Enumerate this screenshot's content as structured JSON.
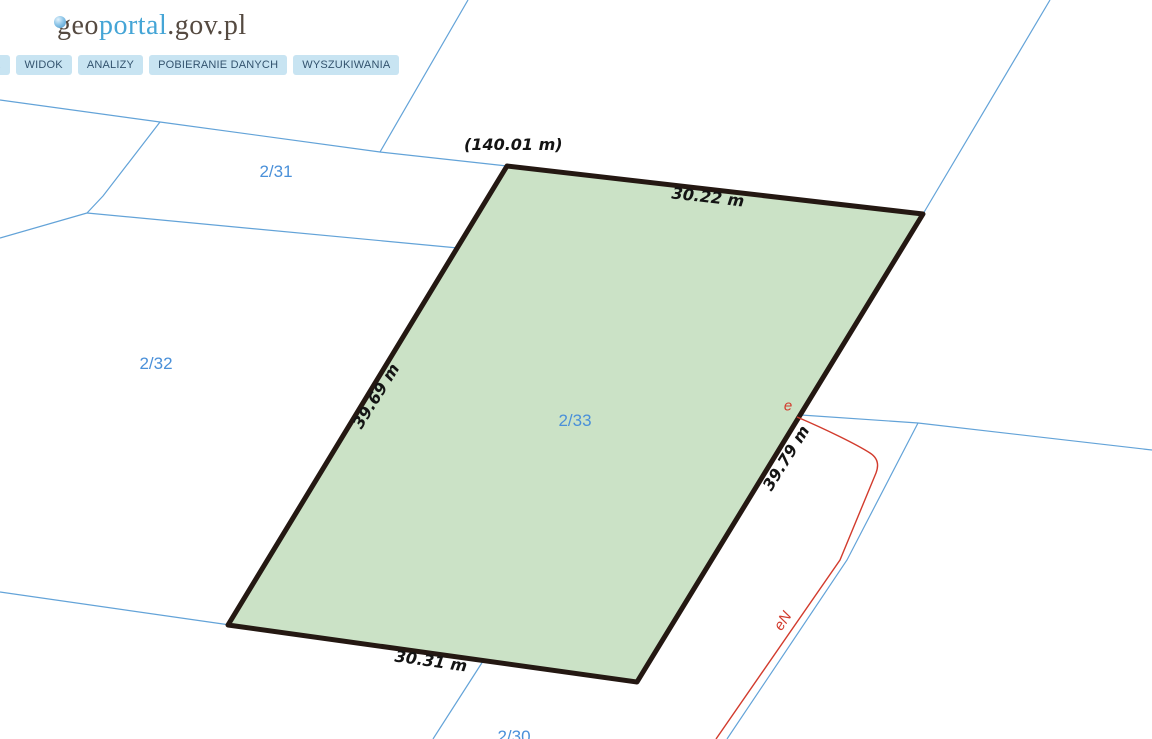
{
  "header": {
    "logo": {
      "geo": "geo",
      "portal": "portal",
      "suffix": ".gov.pl"
    },
    "menu": [
      {
        "label": "K"
      },
      {
        "label": "WIDOK"
      },
      {
        "label": "ANALIZY"
      },
      {
        "label": "POBIERANIE DANYCH"
      },
      {
        "label": "WYSZUKIWANIA"
      }
    ]
  },
  "map": {
    "parcels": [
      {
        "id": "2/31"
      },
      {
        "id": "2/32"
      },
      {
        "id": "2/33"
      },
      {
        "id": "2/30"
      }
    ],
    "selected_parcel": {
      "id": "2/33",
      "perimeter_total": "(140.01 m)",
      "sides": {
        "top": "30.22 m",
        "left": "39.69 m",
        "right": "39.79 m",
        "bottom": "30.31 m"
      }
    },
    "annotations": {
      "point_label": "e",
      "line_label": "eN"
    },
    "colors": {
      "boundary_line": "#63a3d8",
      "parcel_label": "#4a90d9",
      "selected_fill": "#cbe2c6",
      "selected_outline": "#241812",
      "dimension_text": "#141414",
      "red_annotation": "#d23b2d",
      "menu_bg": "#c8e4f2",
      "menu_text": "#33536e",
      "logo_brown": "#554a41",
      "logo_blue": "#45a5d6"
    }
  }
}
